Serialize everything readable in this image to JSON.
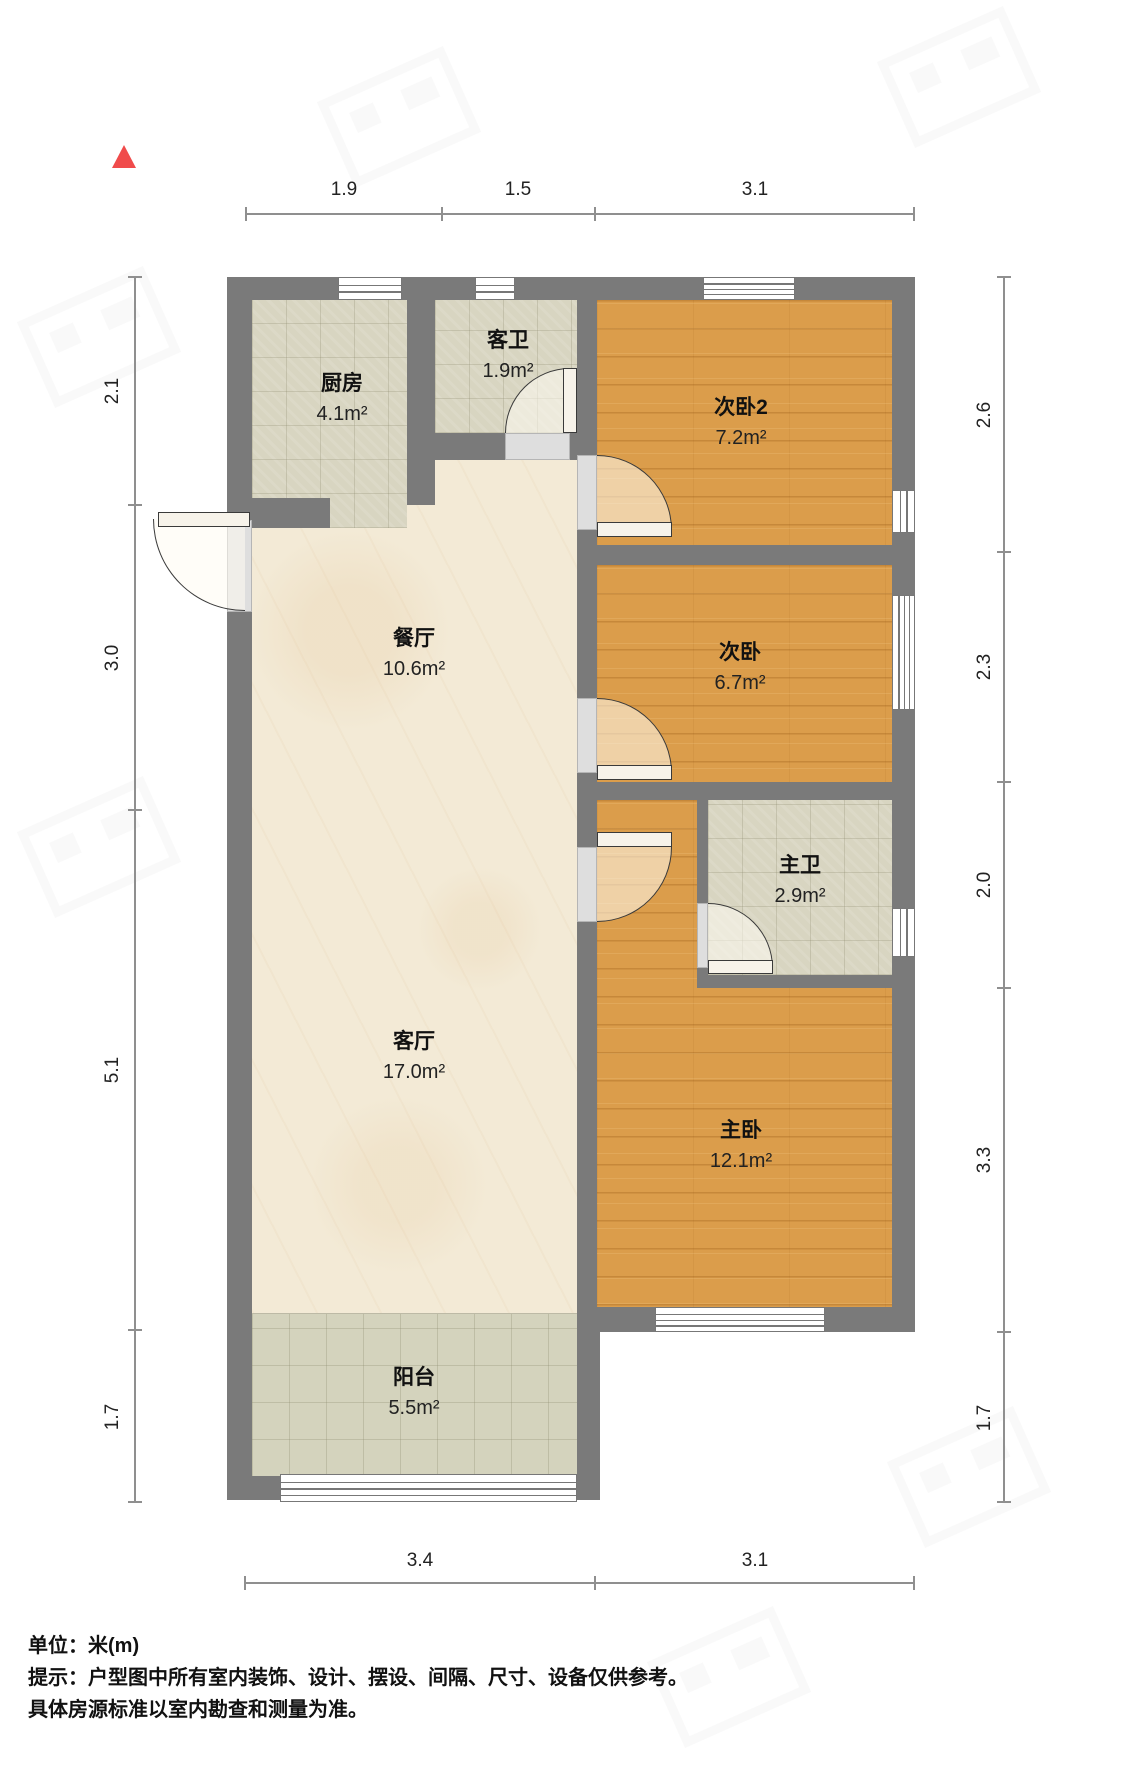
{
  "rooms": {
    "kitchen": {
      "name": "厨房",
      "area": "4.1m²"
    },
    "guest_bath": {
      "name": "客卫",
      "area": "1.9m²"
    },
    "bedroom2": {
      "name": "次卧2",
      "area": "7.2m²"
    },
    "bedroom": {
      "name": "次卧",
      "area": "6.7m²"
    },
    "dining": {
      "name": "餐厅",
      "area": "10.6m²"
    },
    "master_bath": {
      "name": "主卫",
      "area": "2.9m²"
    },
    "living": {
      "name": "客厅",
      "area": "17.0m²"
    },
    "master_bedroom": {
      "name": "主卧",
      "area": "12.1m²"
    },
    "balcony": {
      "name": "阳台",
      "area": "5.5m²"
    }
  },
  "dims": {
    "top": [
      "1.9",
      "1.5",
      "3.1"
    ],
    "bottom": [
      "3.4",
      "3.1"
    ],
    "left": [
      "2.1",
      "3.0",
      "5.1",
      "1.7"
    ],
    "right": [
      "2.6",
      "2.3",
      "2.0",
      "3.3",
      "1.7"
    ]
  },
  "notes": {
    "unit": "单位：米(m)",
    "tip": "提示：户型图中所有室内装饰、设计、摆设、间隔、尺寸、设备仅供参考。",
    "tip2": "具体房源标准以室内勘查和测量为准。"
  },
  "colors": {
    "wall": "#7a7a7a",
    "wood_floor": "#db9d4b",
    "tile_floor": "#d8d5c1",
    "cream_floor": "#f3ead6",
    "balcony_floor": "#d4d3bd",
    "north_indicator": "#f04b4b",
    "dimension_line": "#8f8f8f"
  }
}
